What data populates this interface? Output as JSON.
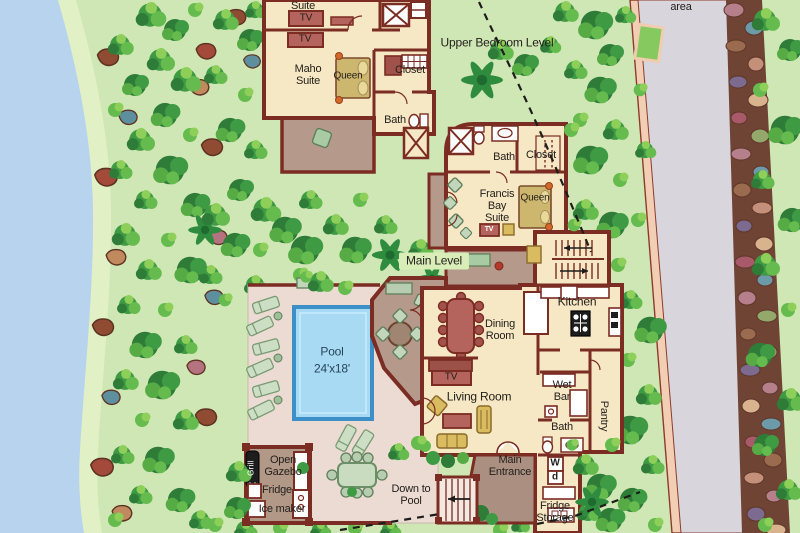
{
  "title": "Villa floor plan site map",
  "levels": {
    "upper": "Upper Bedroom Level",
    "main": "Main Level",
    "parking_area": "area"
  },
  "upper_level": {
    "suite": "Suite",
    "tv1": "TV",
    "tv2": "TV",
    "maho_suite": "Maho Suite",
    "queen": "Queen",
    "closet": "Closet",
    "bath": "Bath"
  },
  "francis_bay": {
    "bath": "Bath",
    "closet": "Closet",
    "suite": "Francis Bay Suite",
    "queen": "Queen",
    "tv": "TV"
  },
  "main_level_rooms": {
    "kitchen": "Kitchen",
    "dining_room": "Dining Room",
    "tv": "TV",
    "living_room": "Living Room",
    "wet_bar": "Wet Bar",
    "pantry": "Pantry",
    "bath": "Bath",
    "washer": "W",
    "dryer": "d",
    "fridge_storage": "Fridge Storage",
    "main_entrance": "Main Entrance"
  },
  "outdoor": {
    "pool_name": "Pool",
    "pool_size": "24'x18'",
    "open_gazebo": "Open Gazebo",
    "grill": "Grill",
    "fridge": "Fridge",
    "ice_maker": "Ice maker",
    "down_to_pool": "Down to Pool"
  },
  "colors": {
    "wall": "#7b2c23",
    "room_floor": "#f6e8c4",
    "deck_mauve": "#b59a8c",
    "pool_deck": "#ecdbd2",
    "pool_water": "#a9daf3",
    "pool_border": "#3c8fc7",
    "sea_water": "#b7d3ee",
    "road": "#d8d5dc",
    "road_border": "#f2cfb4",
    "background_green": "#cfe7b5",
    "furniture_red": "#b4645c",
    "furniture_yellow": "#d9bc60",
    "bed_olive": "#cdb76f"
  }
}
